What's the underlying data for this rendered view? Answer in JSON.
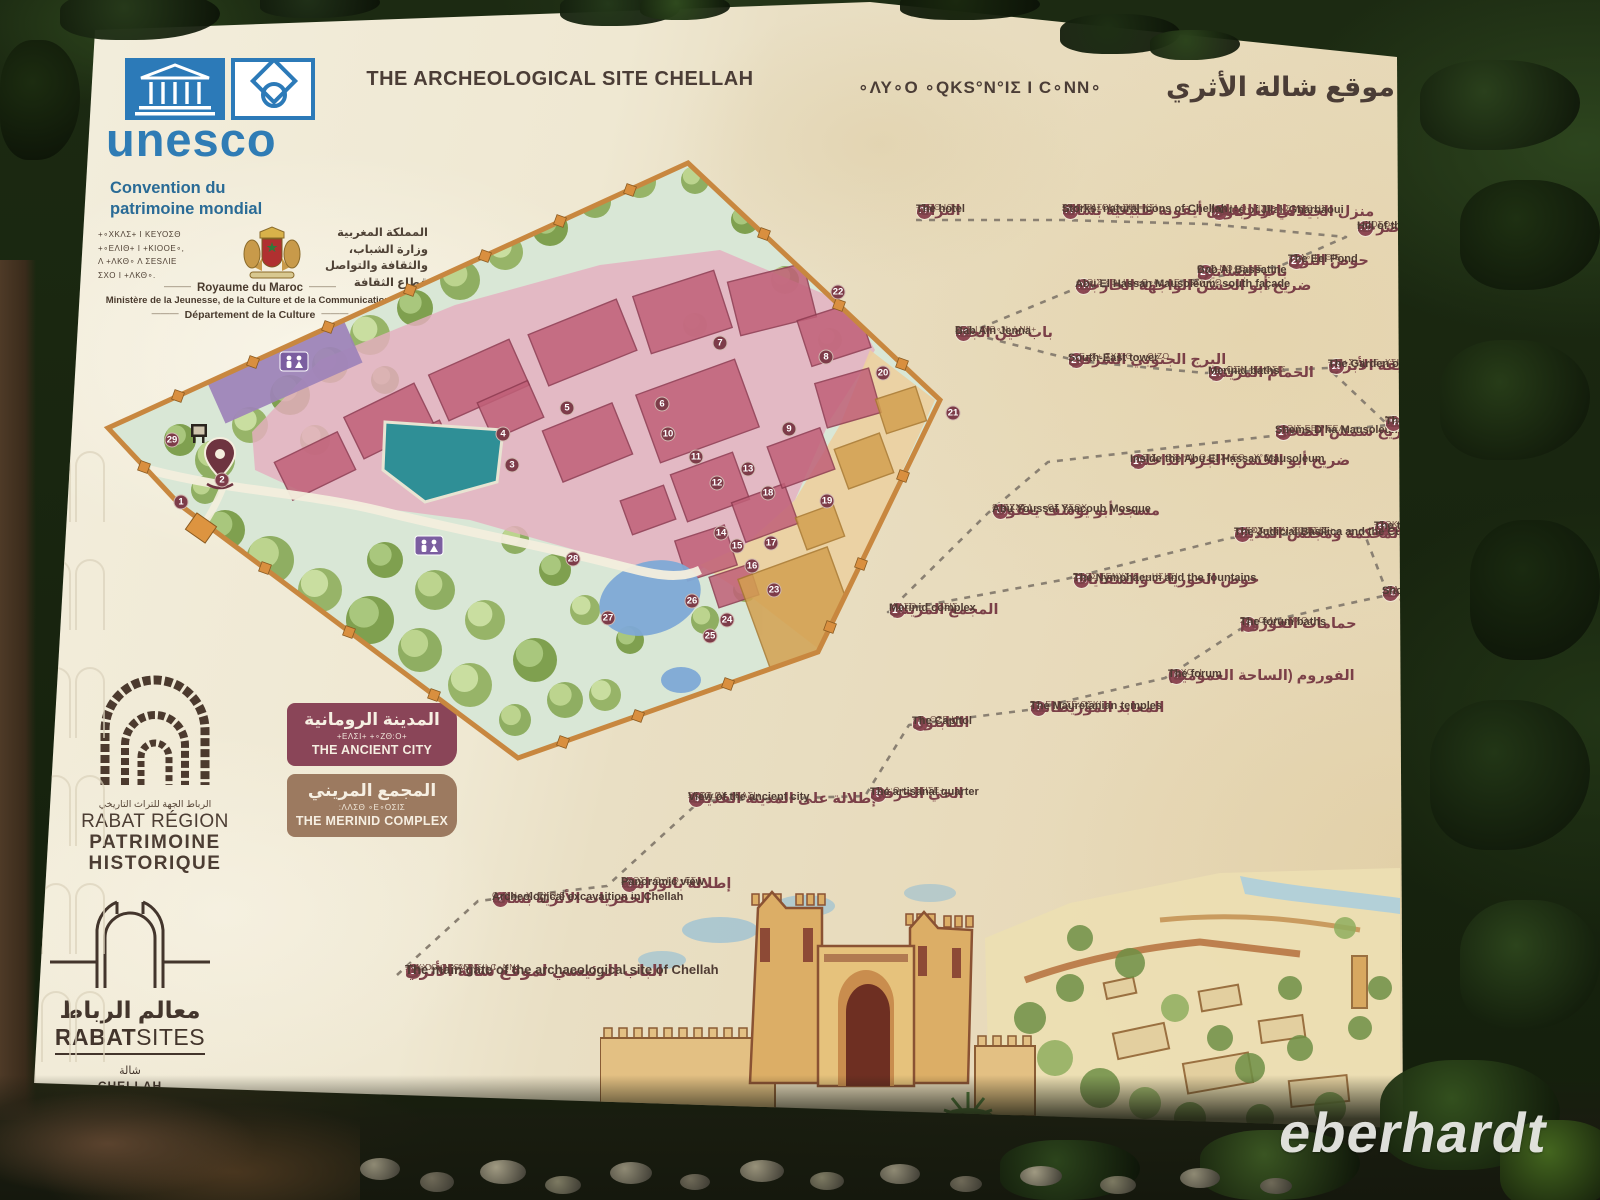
{
  "photo": {
    "watermark": "eberhardt"
  },
  "board": {
    "title": {
      "en": "THE ARCHEOLOGICAL SITE CHELLAH",
      "tifinagh": "∘ΛΥ∘O ∘QΚS°Ν°ΙΣ Ι C∘ΝΝ∘",
      "ar": "موقع شالة الأثري"
    },
    "unesco": {
      "wordmark": "unesco",
      "convention_line1": "Convention du",
      "convention_line2": "patrimoine mondial"
    },
    "morocco": {
      "tifinagh_lines": [
        "+∘ΧΚΛΣ+ Ι ΚΕΥΟΣΘ",
        "+∘ΕΛΙΘ+ Ι +ΚΙΟΟΕ∘,",
        "Λ +ΛΚΘ∘ Λ ΣΕSΛΙΕ",
        "ΣΧΟ Ι +ΛΚΘ∘."
      ],
      "arabic_lines": [
        "المملكة المغربية",
        "وزارة الشباب،",
        "والثقافة والتواصل",
        "قطاع الثقافة"
      ],
      "kingdom": "Royaume du Maroc",
      "ministry": "Ministère de la Jeunesse, de la Culture et de la Communication",
      "department": "Département de la Culture"
    },
    "legend": {
      "items": [
        {
          "ar": "المدينة الرومانية",
          "tif": "+ΕΛΣΙ+ +∘ΖΘ:Ο+",
          "en": "THE ANCIENT CITY",
          "color": "#8a4558"
        },
        {
          "ar": "المجمع المريني",
          "tif": ":ΛΛΣΘ ∘Ε∘ΟΣΙΣ",
          "en": "THE MERINID COMPLEX",
          "color": "#9c7a60"
        }
      ]
    },
    "logos": {
      "rabat_region": {
        "ar": "الرباط الجهة للتراث التاريخي",
        "line1": "RABAT RÉGION",
        "line2": "PATRIMOINE",
        "line3": "HISTORIQUE"
      },
      "rabat_sites": {
        "ar": "معالم الرباط",
        "bold": "RABAT",
        "light": "SITES",
        "site_ar": "شالة",
        "site_en": "CHELLAH"
      }
    },
    "sites": [
      {
        "n": 1,
        "ar": "الباب الرئيسي لموقع شالة الأثري",
        "tif": "+∘ΧΧ:Ο+ +∘ΛΘΝ∘|+ Ι",
        "tif2": ":ΛΥ∘Ο ∘QΚS°Ν°ΙΣ Ι C∘ΝΝ∘",
        "en": "The main gate of the archaeological site of Chellah"
      },
      {
        "n": 2,
        "ar": "الحفريات الأثرية بشالة",
        "tif": "C∘ΝΝ∘ Χ :ΕΧΟ:S",
        "en": "Archeological excavaition in Chellah"
      },
      {
        "n": 3,
        "ar": "إطلالة بانورامية",
        "tif": "ΣΧQΣ ∘Θ∘Ι:Q∘ΕΣ",
        "en": "Panoramic view"
      },
      {
        "n": 4,
        "ar": "إطلالة على المدينة القديمة",
        "tif": "ΣΧQΣ ΧΧ +ΕΛΣΙ+",
        "tif2": "+∘ΖΘ:Ο+",
        "en": "View of the ancient city"
      },
      {
        "n": 5,
        "ar": "الحي الحرفي",
        "tif": "+:ΛΛ:Ο+ +ΣΕΙΣΕ+",
        "en": "The artisanal quarter"
      },
      {
        "n": 6,
        "ar": "الكابتول",
        "tif": "∘R∘ΘΣΕ:Η",
        "en": "The Capitol"
      },
      {
        "n": 7,
        "ar": "المعابد الموريطانية",
        "tif": "ΣΘ:Ε∘Υ ΣΕ:ΟΣΚΙ",
        "en": "The Mauretanian temples"
      },
      {
        "n": 8,
        "ar": "الفوروم (الساحة العمومية)",
        "tif": "∘ΘΧΟ∘Ι",
        "en": "The forum"
      },
      {
        "n": 9,
        "ar": "حمامات الفوروم",
        "tif": "ΣΘ∘Ο:ΛΙ Ι :ΘΧΟ∘Ι",
        "en": "The forum baths"
      },
      {
        "n": 10,
        "ar": "الدكاكين والأروقة",
        "tif": "+ΣΛ:Ι∘ Λ +ΣΟ:Ν",
        "en": "Shops and galleries"
      },
      {
        "n": 11,
        "ar": "قوس النصر",
        "tif": "+ΣΘΚ+ Ι :Ε:ΙΟΘ",
        "en": "The triumphal arch"
      },
      {
        "n": 12,
        "ar": "المحكمة ومجلس المدينة",
        "tif": "+∘ΕΧΧ∘Ν:+ Ι ΣQ:ΕΣΚ",
        "tif2": "+∘ΧΟΧ∘Ι+ Λ +ΘΙΘΕ∘S+",
        "en": "The Judicial Basilica and the Curia"
      },
      {
        "n": 13,
        "ar": "حوض الحوريات والسقايات",
        "tif": "ΣΧΟΣ ΣΕΝΧΣ Λ +∘ΗΣΙΙΣΙ",
        "en": "The Nymphaeum and the fountains"
      },
      {
        "n": 14,
        "ar": "المجمع المريني",
        "tif": ":ΛΛΣΘ ∘Ε∘ΟΣΙΣ",
        "en": "Merinid complex"
      },
      {
        "n": 15,
        "ar": "مسجد أبو يوسف يعقوب",
        "tif": "+∘ΕΧΧΣΛ∘ ∘ΘΣ SΣΘΧ",
        "tif2": "S∘ΛΖ:Θ",
        "en": "Abu Youssef Yaacoub Mosque"
      },
      {
        "n": 16,
        "ar": "ضريح أبو الحسن: الجزء الداخلي",
        "tif": "∘ΛΘΙΣ ∘ΘΣ ΗΛ∘Θ∘Ι: ΣΛΕΘ ∘Χ°Θ∘Ι",
        "en": "Inside the Abu El Hassan Mausoleum"
      },
      {
        "n": 17,
        "ar": "ضريح شمس الضحى",
        "tif": "∘ΛΘΙΣ ΕΕΘ ΕΕΛ∘",
        "en": "Shems D'ha Mausoleum"
      },
      {
        "n": 18,
        "ar": "المدرسة",
        "tif": "ΝΕΛΟΘ+",
        "en": "The Medersa"
      },
      {
        "n": 19,
        "ar": "حديقة الأبراج",
        "tif": "+:Ο+Σ+ Ι +Ε∘ΧΣΙ",
        "en": "The Garden of Towers"
      },
      {
        "n": 20,
        "ar": "الحمام المريني",
        "tif": "∘Θ∘ΟΣΛ ∘Ε∘ΟΣΙΣ",
        "en": "Merinid baths"
      },
      {
        "n": 21,
        "ar": "البرج الجنوبي الشرقي",
        "tif": "+∘Ε∘Χ+ ΣΧΧ:Θ - ∘ΘΙΖΟ",
        "en": "South-East tower"
      },
      {
        "n": 22,
        "ar": "باب عين الجنة",
        "tif": "ΣΕΣ Ι :ΥΘ∘Ν: Ι ΝΙ|+",
        "en": "Bab Ain Jenna"
      },
      {
        "n": 23,
        "ar": "ضريح أبو الحسن الواجهة الخارجية",
        "tif": "∘ΛΘΙΣ ∘Θ: ΗΛ∘Θ∘Ι : :ΛΕ Ι SΣΧΧ:Θ",
        "en": "Abu El Hassan Mausoleum: south façade"
      },
      {
        "n": 24,
        "ar": "باب البساتين",
        "tif": "Θ∘Θ ΝΘ∘Θ∘+Σ",
        "en": "Bab Al Bassatine"
      },
      {
        "n": 25,
        "ar": "حوض النون",
        "tif": "∘ΕΛ∘ Ι +ΘΙΣ",
        "en": "The Eel Pond"
      },
      {
        "n": 26,
        "ar": "تل الأضرحة",
        "tif": "+∘ΙΟΣΟ+ Ι ΣΧ°ΟΛΣΙ",
        "en": "Hill of the marabouts"
      },
      {
        "n": 27,
        "ar": "منزل الجيلالي الغرباوي",
        "tif": "+∘ΛΛ∘Ο+ ΙΙΣΝ∘ΝΣ ΥΟΘ∘ΙΣ",
        "en": "House of Jilali Gharbaoui"
      },
      {
        "n": 28,
        "ar": "طائر اللقلاق أيقونة طبيعية بشالة",
        "tif": "ΣΛ ΘΝΝ∘ΟΙ: +ΣΙΗ∘ΧΣΙ",
        "tif2": "+ΣΧ∘ΕΛΣΙ Ι C∘ΝΝ∘",
        "en": "Storks: natural icons of Chellah"
      },
      {
        "n": 29,
        "ar": "النزالة",
        "tif": "+ΣΘΘ:ΙΘ∘",
        "en": "The hotel"
      }
    ]
  }
}
